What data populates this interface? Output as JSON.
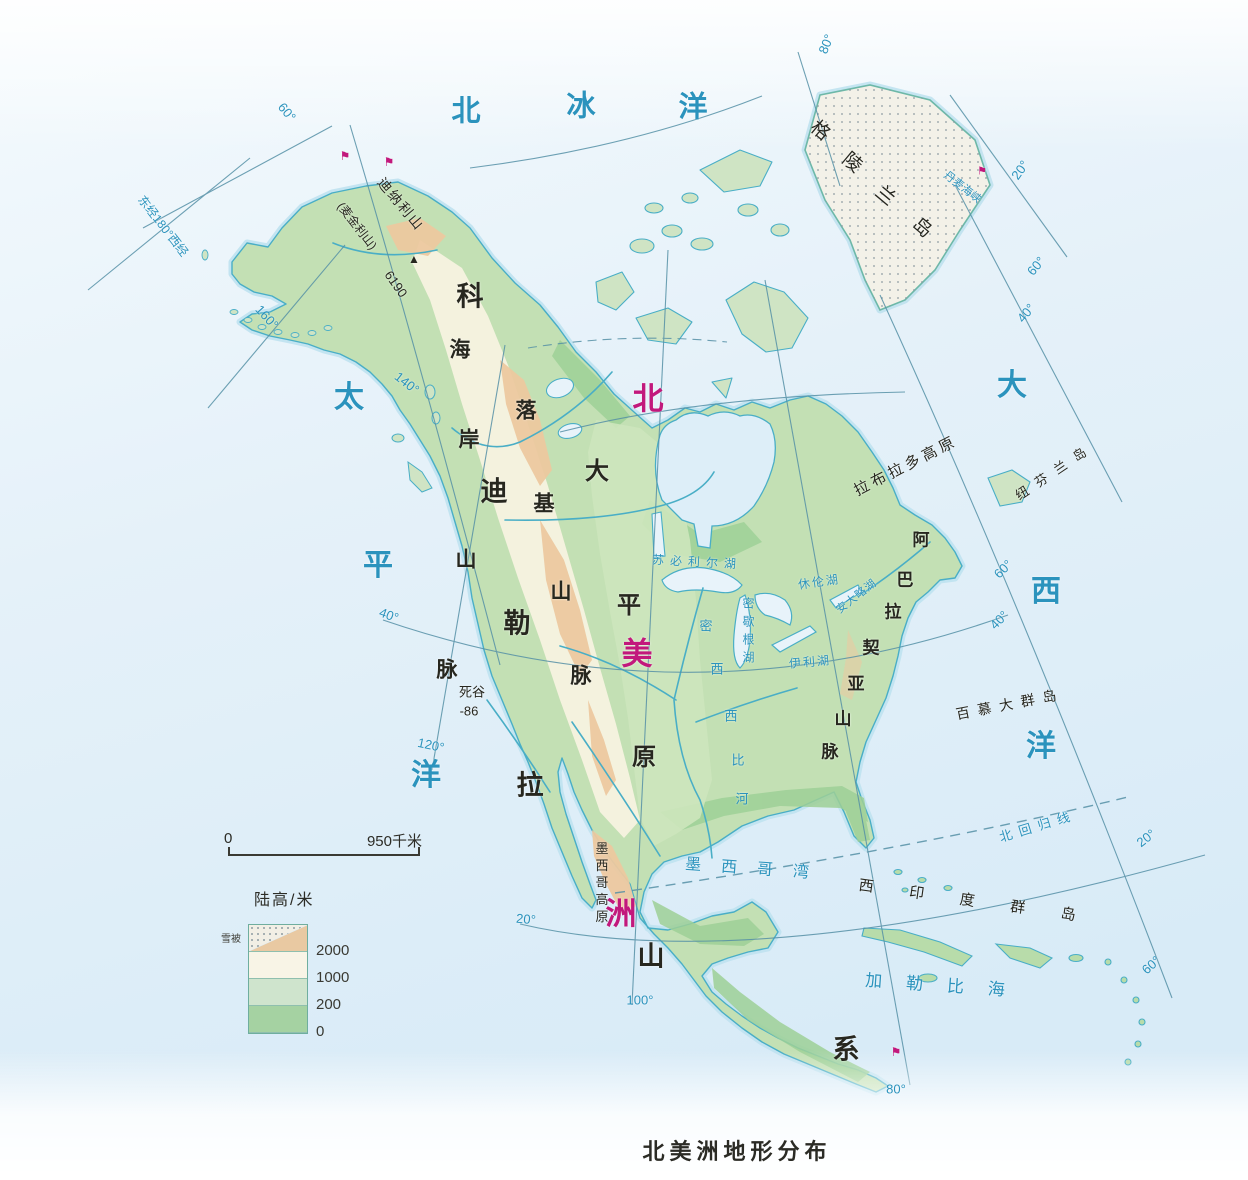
{
  "title": {
    "text": "北美洲地形分布"
  },
  "scale_bar": {
    "start": "0",
    "end": "950千米"
  },
  "legend": {
    "title": "陆高/米",
    "snow_label": "雪被",
    "values": [
      "2000",
      "1000",
      "200",
      "0"
    ],
    "colors": {
      "snow": "#f2efe5",
      "high": "#e9c9a2",
      "mid_high": "#f8f4e6",
      "mid_low": "#cfe4cd",
      "low": "#a5d2a2"
    }
  },
  "colors": {
    "ocean": "#e9f4fb",
    "water_line": "#49aec6",
    "grid_line": "#5590a6",
    "water_text": "#2b93bd",
    "land_text": "#27271f",
    "highlight_text": "#c2187c"
  },
  "map_labels": [
    {
      "t": "北",
      "x": 466,
      "y": 112,
      "s": 29,
      "c": "w",
      "b": 1,
      "n": "label-arctic-ocean"
    },
    {
      "t": "冰",
      "x": 581,
      "y": 107,
      "s": 29,
      "c": "w",
      "b": 1,
      "n": "label-arctic-ocean"
    },
    {
      "t": "洋",
      "x": 693,
      "y": 108,
      "s": 29,
      "c": "w",
      "b": 1,
      "n": "label-arctic-ocean"
    },
    {
      "t": "太",
      "x": 349,
      "y": 398,
      "s": 30,
      "c": "w",
      "b": 1,
      "n": "label-pacific-ocean"
    },
    {
      "t": "平",
      "x": 378,
      "y": 566,
      "s": 30,
      "c": "w",
      "b": 1,
      "n": "label-pacific-ocean"
    },
    {
      "t": "洋",
      "x": 426,
      "y": 776,
      "s": 30,
      "c": "w",
      "b": 1,
      "n": "label-pacific-ocean"
    },
    {
      "t": "大",
      "x": 1012,
      "y": 386,
      "s": 30,
      "c": "w",
      "b": 1,
      "n": "label-atlantic-ocean"
    },
    {
      "t": "西",
      "x": 1046,
      "y": 592,
      "s": 30,
      "c": "w",
      "b": 1,
      "n": "label-atlantic-ocean"
    },
    {
      "t": "洋",
      "x": 1041,
      "y": 747,
      "s": 30,
      "c": "w",
      "b": 1,
      "n": "label-atlantic-ocean"
    },
    {
      "t": "墨西哥湾",
      "x": 757,
      "y": 870,
      "s": 16,
      "c": "w",
      "ls": 20,
      "r": 4,
      "n": "label-gulf-of-mexico"
    },
    {
      "t": "加勒比海",
      "x": 947,
      "y": 986,
      "s": 17,
      "c": "w",
      "ls": 24,
      "r": 4,
      "n": "label-caribbean-sea"
    },
    {
      "t": "北回归线",
      "x": 1038,
      "y": 826,
      "s": 13,
      "c": "w",
      "ls": 7,
      "r": -17,
      "n": "label-tropic-of-cancer"
    },
    {
      "t": "丹麦海峡",
      "x": 962,
      "y": 188,
      "s": 11,
      "c": "w",
      "r": 38,
      "n": "label-denmark-strait"
    },
    {
      "t": "苏必利尔湖",
      "x": 697,
      "y": 562,
      "s": 12,
      "c": "w",
      "ls": 6,
      "r": 3,
      "n": "label-lake-superior"
    },
    {
      "t": "休伦湖",
      "x": 819,
      "y": 582,
      "s": 12,
      "c": "w",
      "r": -8,
      "ls": 2,
      "n": "label-lake-huron"
    },
    {
      "t": "密歇根湖",
      "x": 748,
      "y": 633,
      "s": 12,
      "c": "w",
      "v": 1,
      "ls": 6,
      "n": "label-lake-michigan"
    },
    {
      "t": "安大略湖",
      "x": 857,
      "y": 597,
      "s": 11,
      "c": "w",
      "r": -38,
      "ls": 1,
      "n": "label-lake-ontario"
    },
    {
      "t": "伊利湖",
      "x": 810,
      "y": 662,
      "s": 12,
      "c": "w",
      "r": -5,
      "ls": 2,
      "n": "label-lake-erie"
    },
    {
      "t": "密",
      "x": 706,
      "y": 626,
      "s": 13,
      "c": "w",
      "n": "label-mississippi-river"
    },
    {
      "t": "西",
      "x": 717,
      "y": 669,
      "s": 13,
      "c": "w",
      "n": "label-mississippi-river"
    },
    {
      "t": "西",
      "x": 731,
      "y": 716,
      "s": 13,
      "c": "w",
      "n": "label-mississippi-river"
    },
    {
      "t": "比",
      "x": 738,
      "y": 760,
      "s": 13,
      "c": "w",
      "n": "label-mississippi-river"
    },
    {
      "t": "河",
      "x": 742,
      "y": 799,
      "s": 13,
      "c": "w",
      "n": "label-mississippi-river"
    },
    {
      "t": "东经180°西经",
      "x": 163,
      "y": 226,
      "s": 12,
      "c": "w",
      "r": 52,
      "n": "grid-label-180"
    },
    {
      "t": "60°",
      "x": 287,
      "y": 112,
      "s": 13,
      "c": "w",
      "r": 50,
      "n": "grid-label"
    },
    {
      "t": "160°",
      "x": 267,
      "y": 317,
      "s": 13,
      "c": "w",
      "r": 48,
      "n": "grid-label"
    },
    {
      "t": "140°",
      "x": 407,
      "y": 383,
      "s": 13,
      "c": "w",
      "r": 38,
      "n": "grid-label"
    },
    {
      "t": "40°",
      "x": 389,
      "y": 615,
      "s": 13,
      "c": "w",
      "r": 20,
      "n": "grid-label"
    },
    {
      "t": "120°",
      "x": 431,
      "y": 745,
      "s": 13,
      "c": "w",
      "r": 12,
      "n": "grid-label"
    },
    {
      "t": "20°",
      "x": 526,
      "y": 919,
      "s": 13,
      "c": "w",
      "r": 5,
      "n": "grid-label"
    },
    {
      "t": "100°",
      "x": 640,
      "y": 1000,
      "s": 13,
      "c": "w",
      "n": "grid-label"
    },
    {
      "t": "80°",
      "x": 896,
      "y": 1089,
      "s": 13,
      "c": "w",
      "n": "grid-label"
    },
    {
      "t": "60°",
      "x": 1151,
      "y": 965,
      "s": 13,
      "c": "w",
      "r": -42,
      "n": "grid-label"
    },
    {
      "t": "20°",
      "x": 1146,
      "y": 838,
      "s": 13,
      "c": "w",
      "r": -38,
      "n": "grid-label"
    },
    {
      "t": "40°",
      "x": 999,
      "y": 620,
      "s": 13,
      "c": "w",
      "r": -45,
      "n": "grid-label"
    },
    {
      "t": "60°",
      "x": 1003,
      "y": 569,
      "s": 13,
      "c": "w",
      "r": -45,
      "n": "grid-label"
    },
    {
      "t": "40°",
      "x": 1026,
      "y": 313,
      "s": 13,
      "c": "w",
      "r": -50,
      "n": "grid-label"
    },
    {
      "t": "60°",
      "x": 1036,
      "y": 266,
      "s": 13,
      "c": "w",
      "r": -50,
      "n": "grid-label"
    },
    {
      "t": "20°",
      "x": 1020,
      "y": 170,
      "s": 13,
      "c": "w",
      "r": -55,
      "n": "grid-label"
    },
    {
      "t": "80°",
      "x": 826,
      "y": 44,
      "s": 13,
      "c": "w",
      "r": -68,
      "n": "grid-label"
    },
    {
      "t": "格",
      "x": 820,
      "y": 131,
      "s": 19,
      "c": "k",
      "r": 40,
      "n": "label-greenland"
    },
    {
      "t": "陵",
      "x": 852,
      "y": 163,
      "s": 19,
      "c": "k",
      "r": 40,
      "n": "label-greenland"
    },
    {
      "t": "兰",
      "x": 885,
      "y": 196,
      "s": 19,
      "c": "k",
      "r": 40,
      "n": "label-greenland"
    },
    {
      "t": "岛",
      "x": 922,
      "y": 228,
      "s": 19,
      "c": "k",
      "r": 40,
      "n": "label-greenland"
    },
    {
      "t": "拉布拉多高原",
      "x": 906,
      "y": 466,
      "s": 15,
      "c": "k",
      "r": -27,
      "ls": 4,
      "n": "label-labrador-plateau"
    },
    {
      "t": "纽芬兰岛",
      "x": 1055,
      "y": 471,
      "s": 13,
      "c": "k",
      "r": -34,
      "ls": 10,
      "n": "label-newfoundland"
    },
    {
      "t": "百慕大群岛",
      "x": 1010,
      "y": 704,
      "s": 14,
      "c": "k",
      "r": -11,
      "ls": 8,
      "n": "label-bermuda"
    },
    {
      "t": "西印度群岛",
      "x": 985,
      "y": 903,
      "s": 15,
      "c": "k",
      "r": 8,
      "ls": 36,
      "n": "label-west-indies"
    },
    {
      "t": "墨西哥高原",
      "x": 601,
      "y": 884,
      "s": 13,
      "c": "k",
      "v": 1,
      "ls": 4,
      "n": "label-mexican-plateau"
    },
    {
      "t": "死谷",
      "x": 472,
      "y": 692,
      "s": 13,
      "c": "k",
      "n": "label-death-valley"
    },
    {
      "t": "-86",
      "x": 469,
      "y": 711,
      "s": 13,
      "c": "k",
      "n": "label-death-valley-depth"
    },
    {
      "t": "迪纳利山",
      "x": 401,
      "y": 204,
      "s": 14,
      "c": "k",
      "r": 50,
      "ls": 2,
      "n": "label-denali"
    },
    {
      "t": "(麦金利山)",
      "x": 357,
      "y": 226,
      "s": 12,
      "c": "k",
      "r": 52,
      "n": "label-mckinley"
    },
    {
      "t": "6190",
      "x": 396,
      "y": 284,
      "s": 13,
      "c": "k",
      "r": 55,
      "n": "label-denali-elevation"
    },
    {
      "t": "▲",
      "x": 414,
      "y": 259,
      "s": 12,
      "c": "k",
      "n": "peak-icon"
    },
    {
      "t": "科",
      "x": 470,
      "y": 297,
      "s": 27,
      "c": "k",
      "b": 1,
      "n": "label-cordillera"
    },
    {
      "t": "迪",
      "x": 494,
      "y": 492,
      "s": 27,
      "c": "k",
      "b": 1,
      "n": "label-cordillera"
    },
    {
      "t": "勒",
      "x": 517,
      "y": 624,
      "s": 27,
      "c": "k",
      "b": 1,
      "n": "label-cordillera"
    },
    {
      "t": "拉",
      "x": 530,
      "y": 786,
      "s": 27,
      "c": "k",
      "b": 1,
      "n": "label-cordillera"
    },
    {
      "t": "山",
      "x": 651,
      "y": 957,
      "s": 27,
      "c": "k",
      "b": 1,
      "n": "label-cordillera"
    },
    {
      "t": "系",
      "x": 846,
      "y": 1050,
      "s": 27,
      "c": "k",
      "b": 1,
      "n": "label-cordillera"
    },
    {
      "t": "海",
      "x": 460,
      "y": 350,
      "s": 21,
      "c": "k",
      "b": 1,
      "n": "label-coast-range"
    },
    {
      "t": "岸",
      "x": 469,
      "y": 440,
      "s": 21,
      "c": "k",
      "b": 1,
      "n": "label-coast-range"
    },
    {
      "t": "山",
      "x": 466,
      "y": 560,
      "s": 21,
      "c": "k",
      "b": 1,
      "n": "label-coast-range"
    },
    {
      "t": "脉",
      "x": 447,
      "y": 670,
      "s": 21,
      "c": "k",
      "b": 1,
      "n": "label-coast-range"
    },
    {
      "t": "落",
      "x": 526,
      "y": 411,
      "s": 21,
      "c": "k",
      "b": 1,
      "n": "label-rocky-mountains"
    },
    {
      "t": "基",
      "x": 544,
      "y": 504,
      "s": 21,
      "c": "k",
      "b": 1,
      "n": "label-rocky-mountains"
    },
    {
      "t": "山",
      "x": 561,
      "y": 592,
      "s": 21,
      "c": "k",
      "b": 1,
      "n": "label-rocky-mountains"
    },
    {
      "t": "脉",
      "x": 581,
      "y": 676,
      "s": 21,
      "c": "k",
      "b": 1,
      "n": "label-rocky-mountains"
    },
    {
      "t": "大",
      "x": 597,
      "y": 472,
      "s": 24,
      "c": "k",
      "b": 1,
      "n": "label-great-plains"
    },
    {
      "t": "平",
      "x": 629,
      "y": 606,
      "s": 24,
      "c": "k",
      "b": 1,
      "n": "label-great-plains"
    },
    {
      "t": "原",
      "x": 644,
      "y": 758,
      "s": 24,
      "c": "k",
      "b": 1,
      "n": "label-great-plains"
    },
    {
      "t": "阿",
      "x": 921,
      "y": 540,
      "s": 17,
      "c": "k",
      "b": 1,
      "n": "label-appalachian"
    },
    {
      "t": "巴",
      "x": 905,
      "y": 580,
      "s": 17,
      "c": "k",
      "b": 1,
      "n": "label-appalachian"
    },
    {
      "t": "拉",
      "x": 893,
      "y": 612,
      "s": 17,
      "c": "k",
      "b": 1,
      "n": "label-appalachian"
    },
    {
      "t": "契",
      "x": 871,
      "y": 648,
      "s": 17,
      "c": "k",
      "b": 1,
      "n": "label-appalachian"
    },
    {
      "t": "亚",
      "x": 856,
      "y": 684,
      "s": 17,
      "c": "k",
      "b": 1,
      "n": "label-appalachian"
    },
    {
      "t": "山",
      "x": 843,
      "y": 719,
      "s": 17,
      "c": "k",
      "b": 1,
      "n": "label-appalachian"
    },
    {
      "t": "脉",
      "x": 830,
      "y": 752,
      "s": 17,
      "c": "k",
      "b": 1,
      "n": "label-appalachian"
    },
    {
      "t": "北",
      "x": 648,
      "y": 399,
      "s": 31,
      "c": "m",
      "b": 1,
      "n": "label-north-america"
    },
    {
      "t": "美",
      "x": 637,
      "y": 654,
      "s": 31,
      "c": "m",
      "b": 1,
      "n": "label-north-america"
    },
    {
      "t": "洲",
      "x": 621,
      "y": 914,
      "s": 31,
      "c": "m",
      "b": 1,
      "n": "label-north-america"
    },
    {
      "t": "⚑",
      "x": 345,
      "y": 156,
      "s": 12,
      "c": "m",
      "n": "volcano-marker"
    },
    {
      "t": "⚑",
      "x": 389,
      "y": 162,
      "s": 12,
      "c": "m",
      "n": "volcano-marker"
    },
    {
      "t": "⚑",
      "x": 982,
      "y": 172,
      "s": 11,
      "c": "m",
      "n": "volcano-marker"
    },
    {
      "t": "⚑",
      "x": 896,
      "y": 1052,
      "s": 12,
      "c": "m",
      "n": "volcano-marker"
    }
  ]
}
